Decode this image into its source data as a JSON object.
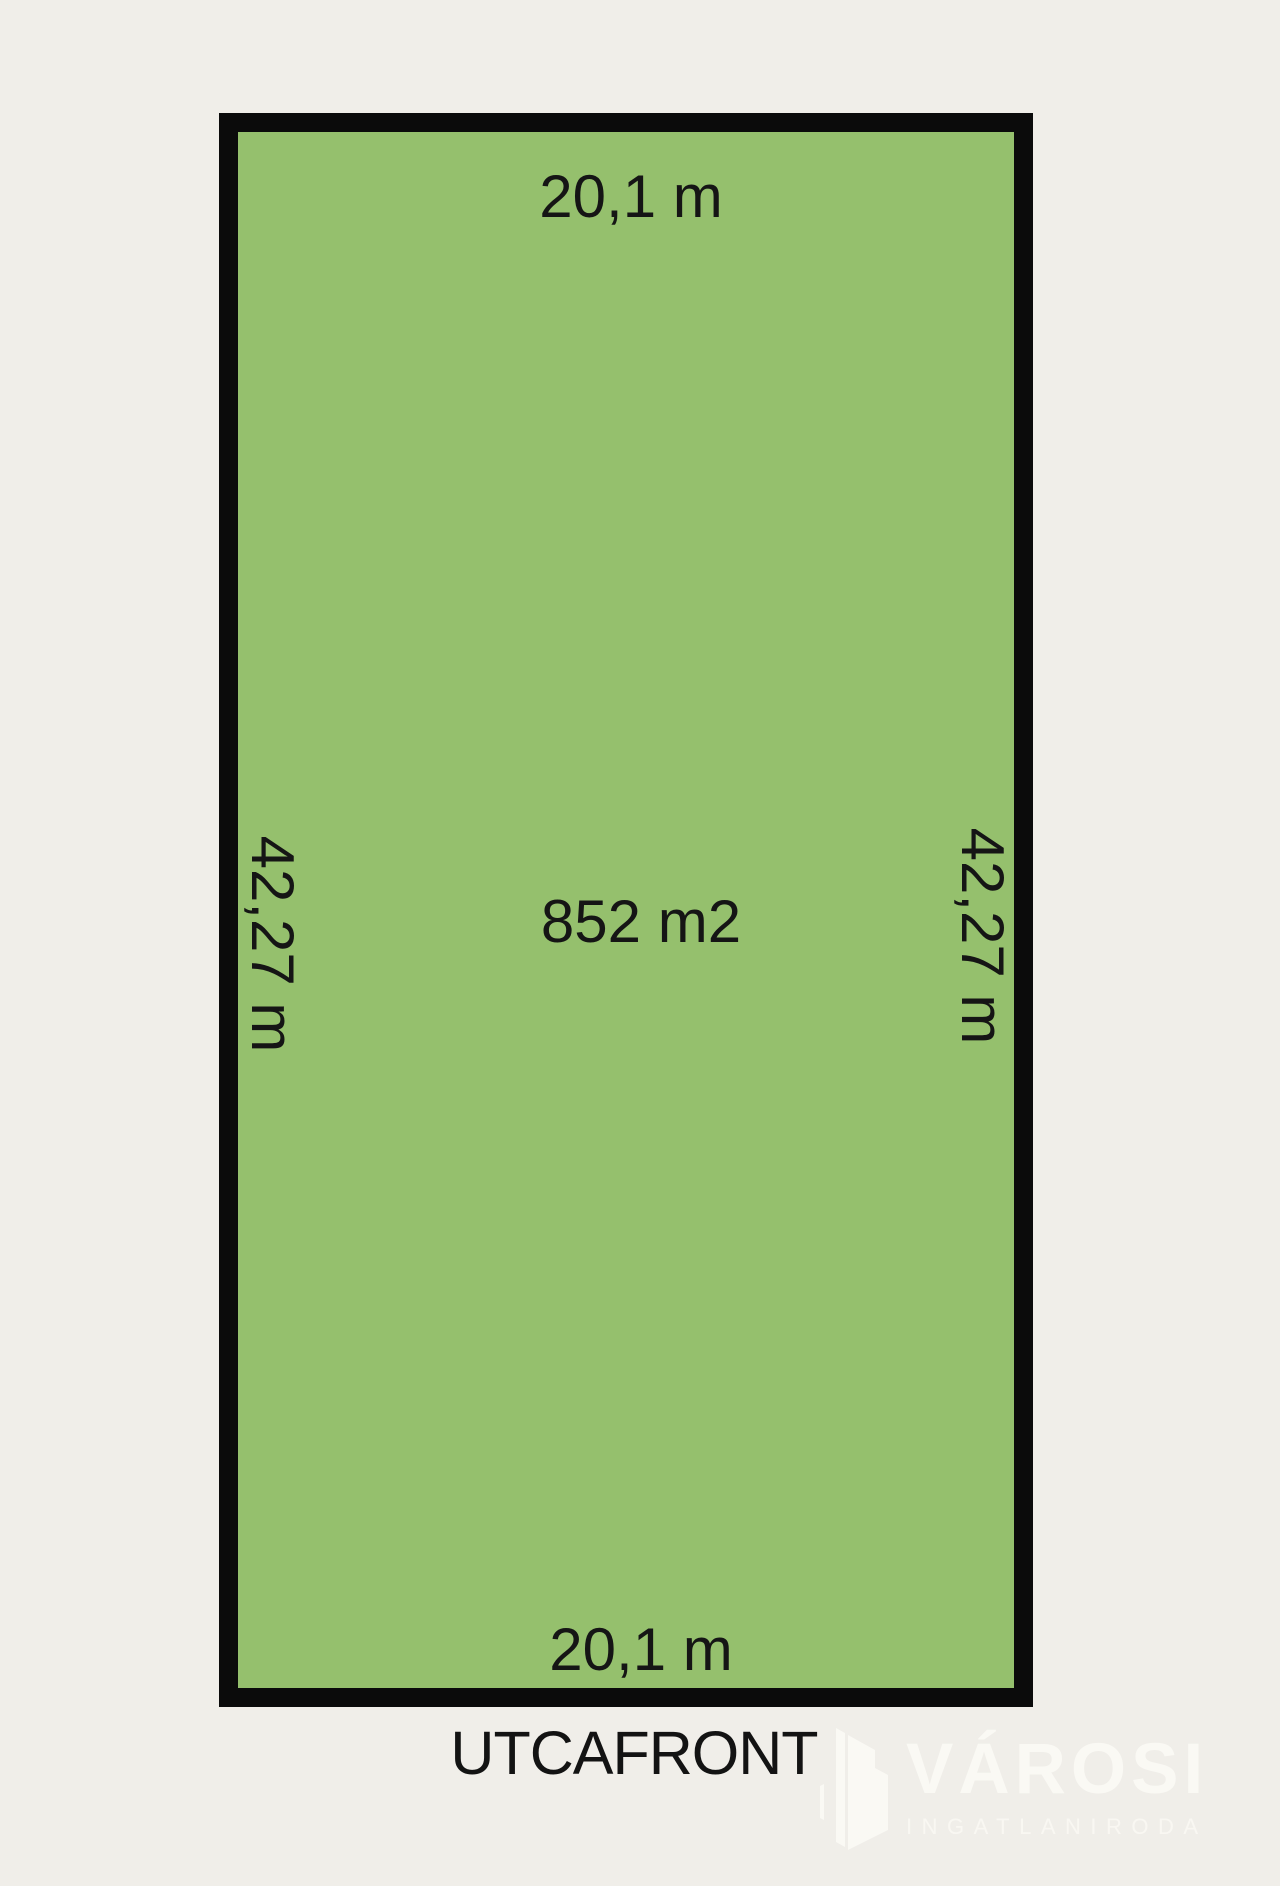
{
  "background_color": "#F0EEE9",
  "plot": {
    "fill_color": "#95C06D",
    "border_color": "#0B0B0B",
    "area_label": "852 m2",
    "top_width_label": "20,1 m",
    "bottom_width_label": "20,1 m",
    "left_length_label": "42,27 m",
    "right_length_label": "42,27 m"
  },
  "street": {
    "front_label": "UTCAFRONT"
  },
  "logo": {
    "brand": "VÁROSI",
    "subtitle": "INGATLANIRODA",
    "icon": "city-buildings-icon",
    "color": "#FAF9F4"
  }
}
